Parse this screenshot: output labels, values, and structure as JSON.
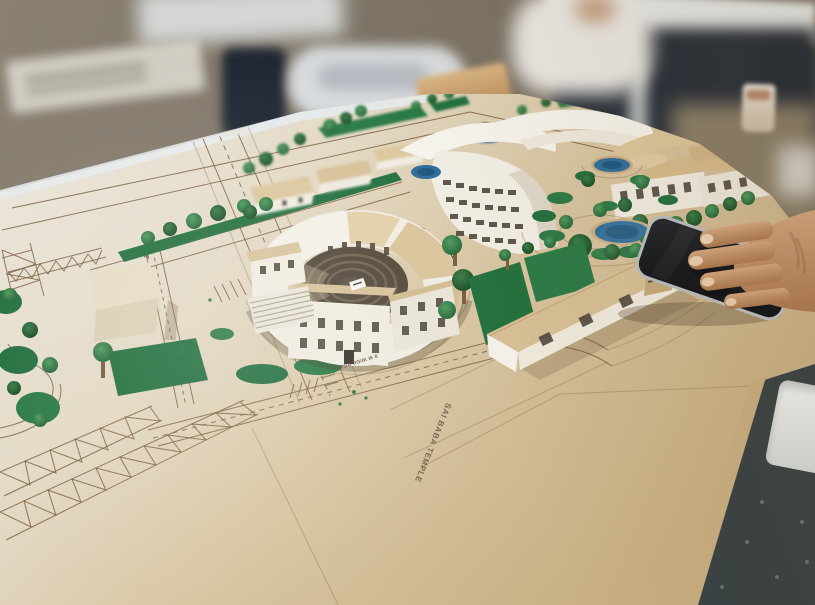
{
  "scene_labels": {
    "temple_plot": "SAI BABA TEMPLE",
    "road_primary": "9 M WIDE ROAD"
  },
  "palette": {
    "board_mdf_tan": "#cdb68f",
    "board_paper_white": "#e9e5da",
    "felt_green": "#24703f",
    "tree_green": "#2d6e3b",
    "pond_blue": "#2e6f9e",
    "cardboard_roof": "#d8c29a",
    "building_white": "#f1eee5",
    "plan_line_brown": "#7c5f3e",
    "table_dark": "#384144",
    "wall_olive": "#7d7466",
    "hand_skin": "#c89a74",
    "phone_screen": "#14171c",
    "phone_frame": "#b5b9bd"
  }
}
